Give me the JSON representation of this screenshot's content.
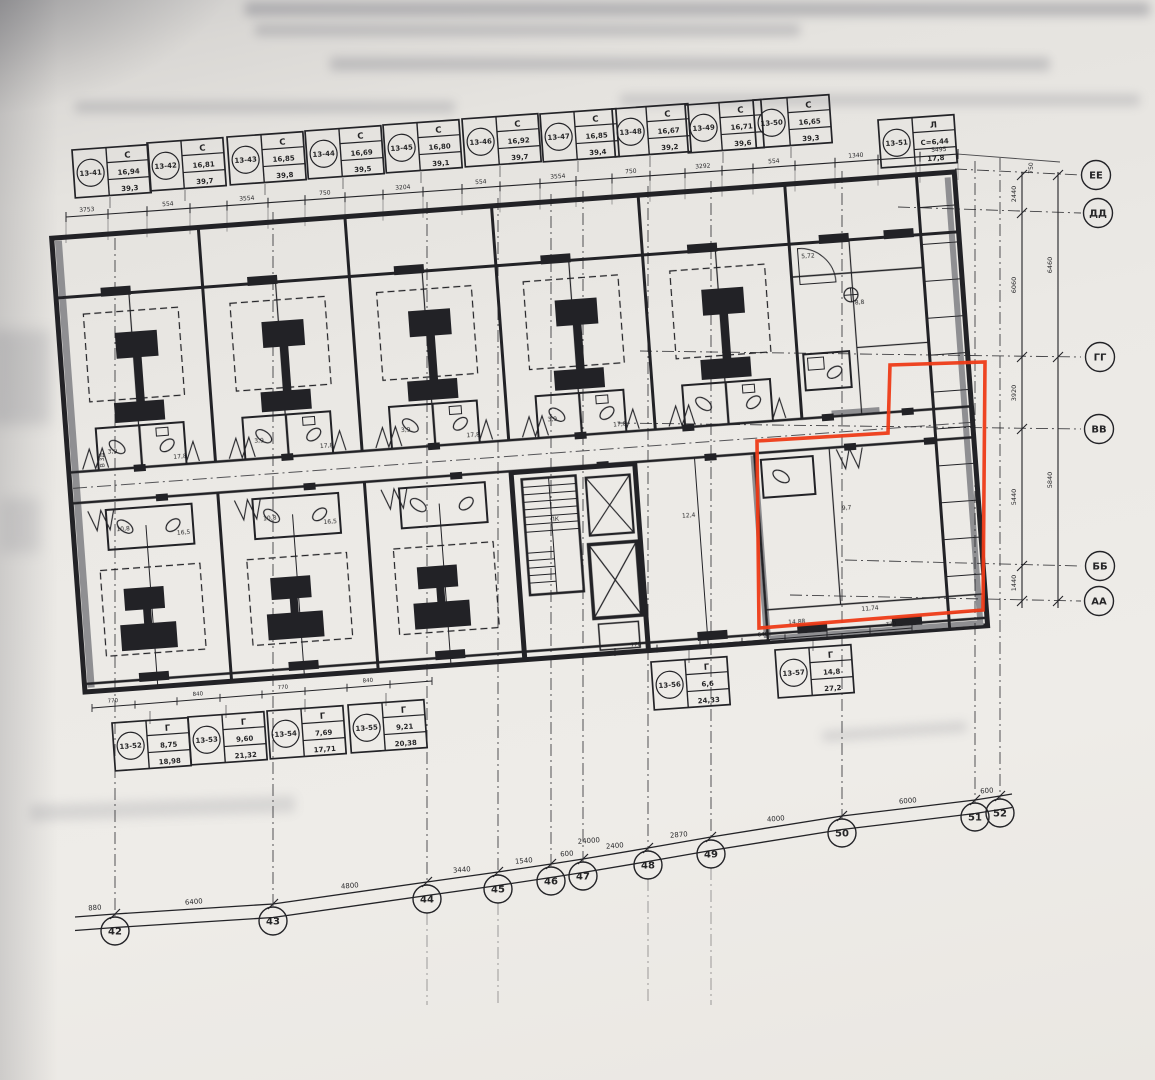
{
  "colors": {
    "ink": "#232327",
    "gray_wall": "#8f8f92",
    "red": "#ee3b17",
    "paper": "#eceae6"
  },
  "axes_bottom": [
    "42",
    "43",
    "44",
    "45",
    "46",
    "47",
    "48",
    "49",
    "50",
    "51",
    "52"
  ],
  "axes_right": [
    "ЕЕ",
    "ДД",
    "ГГ",
    "ВВ",
    "ББ",
    "АА"
  ],
  "dims_bottom": {
    "segments": [
      "880",
      "6400",
      "4800",
      "3440",
      "1540",
      "600",
      "2400",
      "2870",
      "4000",
      "6000",
      "600"
    ],
    "total": "24000"
  },
  "dims_top": [
    "3753",
    "554",
    "3554",
    "750",
    "3204",
    "554",
    "3554",
    "750",
    "3292",
    "554",
    "1340",
    "5495"
  ],
  "dims_right_inner": [
    "2440",
    "6060",
    "3920",
    "5440",
    "1440"
  ],
  "dims_right_outer": [
    "6460",
    "5840"
  ],
  "dims_right_top": "750",
  "dims_stamp_rails": {
    "r1": [
      "770",
      "840",
      "770",
      "840"
    ],
    "r2": [
      "770",
      "640",
      "770"
    ]
  },
  "stamps_top": [
    {
      "no": "13-41",
      "h": "С",
      "v1": "16,94",
      "v2": "39,3"
    },
    {
      "no": "13-42",
      "h": "С",
      "v1": "16,81",
      "v2": "39,7"
    },
    {
      "no": "13-43",
      "h": "С",
      "v1": "16,85",
      "v2": "39,8"
    },
    {
      "no": "13-44",
      "h": "С",
      "v1": "16,69",
      "v2": "39,5"
    },
    {
      "no": "13-45",
      "h": "С",
      "v1": "16,80",
      "v2": "39,1"
    },
    {
      "no": "13-46",
      "h": "С",
      "v1": "16,92",
      "v2": "39,7"
    },
    {
      "no": "13-47",
      "h": "С",
      "v1": "16,85",
      "v2": "39,4"
    },
    {
      "no": "13-48",
      "h": "С",
      "v1": "16,67",
      "v2": "39,2"
    },
    {
      "no": "13-49",
      "h": "С",
      "v1": "16,71",
      "v2": "39,6"
    },
    {
      "no": "13-50",
      "h": "С",
      "v1": "16,65",
      "v2": "39,3"
    },
    {
      "no": "13-51",
      "h": "Л",
      "v1": "С=6,44",
      "v2": "17,8"
    }
  ],
  "stamps_bottom": [
    {
      "no": "13-52",
      "h": "Г",
      "v1": "8,75",
      "v2": "18,98"
    },
    {
      "no": "13-53",
      "h": "Г",
      "v1": "9,60",
      "v2": "21,32"
    },
    {
      "no": "13-54",
      "h": "Г",
      "v1": "7,69",
      "v2": "17,71"
    },
    {
      "no": "13-55",
      "h": "Г",
      "v1": "9,21",
      "v2": "20,38"
    },
    {
      "no": "13-56",
      "h": "Г",
      "v1": "6,6",
      "v2": "24,33"
    },
    {
      "no": "13-57",
      "h": "Г",
      "v1": "14,8",
      "v2": "27,2"
    }
  ],
  "room_labels": [
    "В 3Д",
    "ЛК",
    "17,8",
    "3,9",
    "17,8",
    "3,9",
    "17,8",
    "3,9",
    "17,8",
    "3,9",
    "16,5",
    "10,8",
    "16,5",
    "10,8",
    "9,7",
    "5,72",
    "8,8",
    "14,88",
    "11,74",
    "12,4"
  ]
}
